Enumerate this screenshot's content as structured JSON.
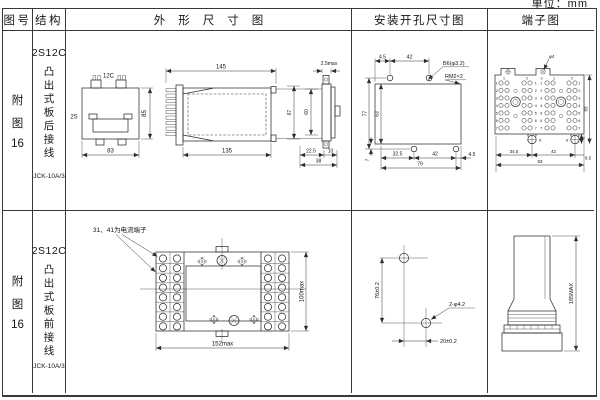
{
  "page": {
    "unit_label": "单位：mm"
  },
  "table": {
    "headers": {
      "figure": "图号",
      "structure": "结构",
      "outline": "外形尺寸图",
      "install": "安装开孔尺寸图",
      "terminal": "端子图"
    },
    "rows": [
      {
        "figure": [
          "附",
          "图",
          "16"
        ],
        "model": "2S12C",
        "wiring": "凸出式板后接线",
        "type": "JCK-10A/3"
      },
      {
        "figure": [
          "附",
          "图",
          "16"
        ],
        "model": "2S12C",
        "wiring": "凸出式板前接线",
        "type": "JCK-10A/3"
      }
    ]
  },
  "drawings": {
    "r1_outline": {
      "front_top": "12C",
      "front_left": "2S",
      "front_width": "83",
      "front_height": "85",
      "side_top": "145",
      "side_bottom": "135",
      "edge_thickness": "2.5max",
      "edge_h1": "67",
      "edge_h2": "60",
      "edge_b1": "22.5",
      "edge_b2": "10",
      "edge_b3": "38"
    },
    "r1_install": {
      "top1": "4.5",
      "top2": "42",
      "hole_label": "B6(φ3.2)",
      "thread_label": "RM2×2",
      "left1": "77",
      "left2": "63",
      "left3": "7",
      "bottom1": "32.5",
      "bottom2": "42",
      "bottom3": "4.5",
      "bottom4": "79"
    },
    "r1_terminal": {
      "hole_label": "φ4",
      "rows": [
        "1",
        "2",
        "3",
        "4",
        "5",
        "6",
        "7"
      ],
      "cols": [
        "1",
        "2",
        "3",
        "1",
        "2"
      ],
      "bottom_num": "8",
      "foot_dim": "4",
      "height": "83",
      "bottom1": "34.5",
      "bottom2": "42",
      "bottom3": "6.5",
      "bottom4": "83"
    },
    "r2_outline": {
      "note": "31、41为电流端子",
      "width": "152max",
      "height": "100max"
    },
    "r2_install": {
      "v_dim": "76±0.2",
      "h_dim": "20±0.2",
      "hole_label": "2-φ4.2"
    },
    "r2_terminal": {
      "height": "185MAX"
    }
  }
}
